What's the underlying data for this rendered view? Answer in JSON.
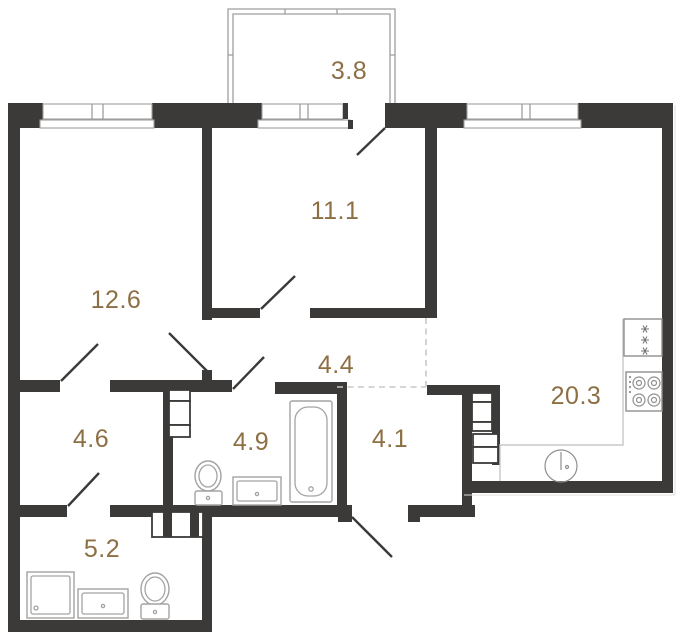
{
  "plan": {
    "kind": "apartment-floor-plan"
  },
  "rooms": [
    {
      "id": "balcony",
      "area": "3.8"
    },
    {
      "id": "bedroom",
      "area": "11.1"
    },
    {
      "id": "living-room",
      "area": "12.6"
    },
    {
      "id": "hallway",
      "area": "4.4"
    },
    {
      "id": "dressing-room",
      "area": "4.6"
    },
    {
      "id": "bathroom",
      "area": "4.9"
    },
    {
      "id": "entrance-hall",
      "area": "4.1"
    },
    {
      "id": "kitchen-living",
      "area": "20.3"
    },
    {
      "id": "shower-room",
      "area": "5.2"
    }
  ],
  "icons": {
    "bathroom_4_9": [
      "toilet",
      "vanity-sink",
      "bathtub"
    ],
    "shower_room_5_2": [
      "shower-tray",
      "vanity-sink",
      "toilet"
    ],
    "kitchen_20_3": [
      "fridge",
      "stove",
      "round-sink",
      "counter"
    ],
    "service": [
      "vent-shaft"
    ]
  },
  "colors": {
    "background": "#ffffff",
    "wall": "#3b3a39",
    "label": "#8d6f44",
    "fixture": "#a3a3a3",
    "appliance": "#8f8f8f",
    "counter": "#c8c8c8",
    "dashed": "#c8c8c8",
    "glazing": "#9e9e9e"
  }
}
